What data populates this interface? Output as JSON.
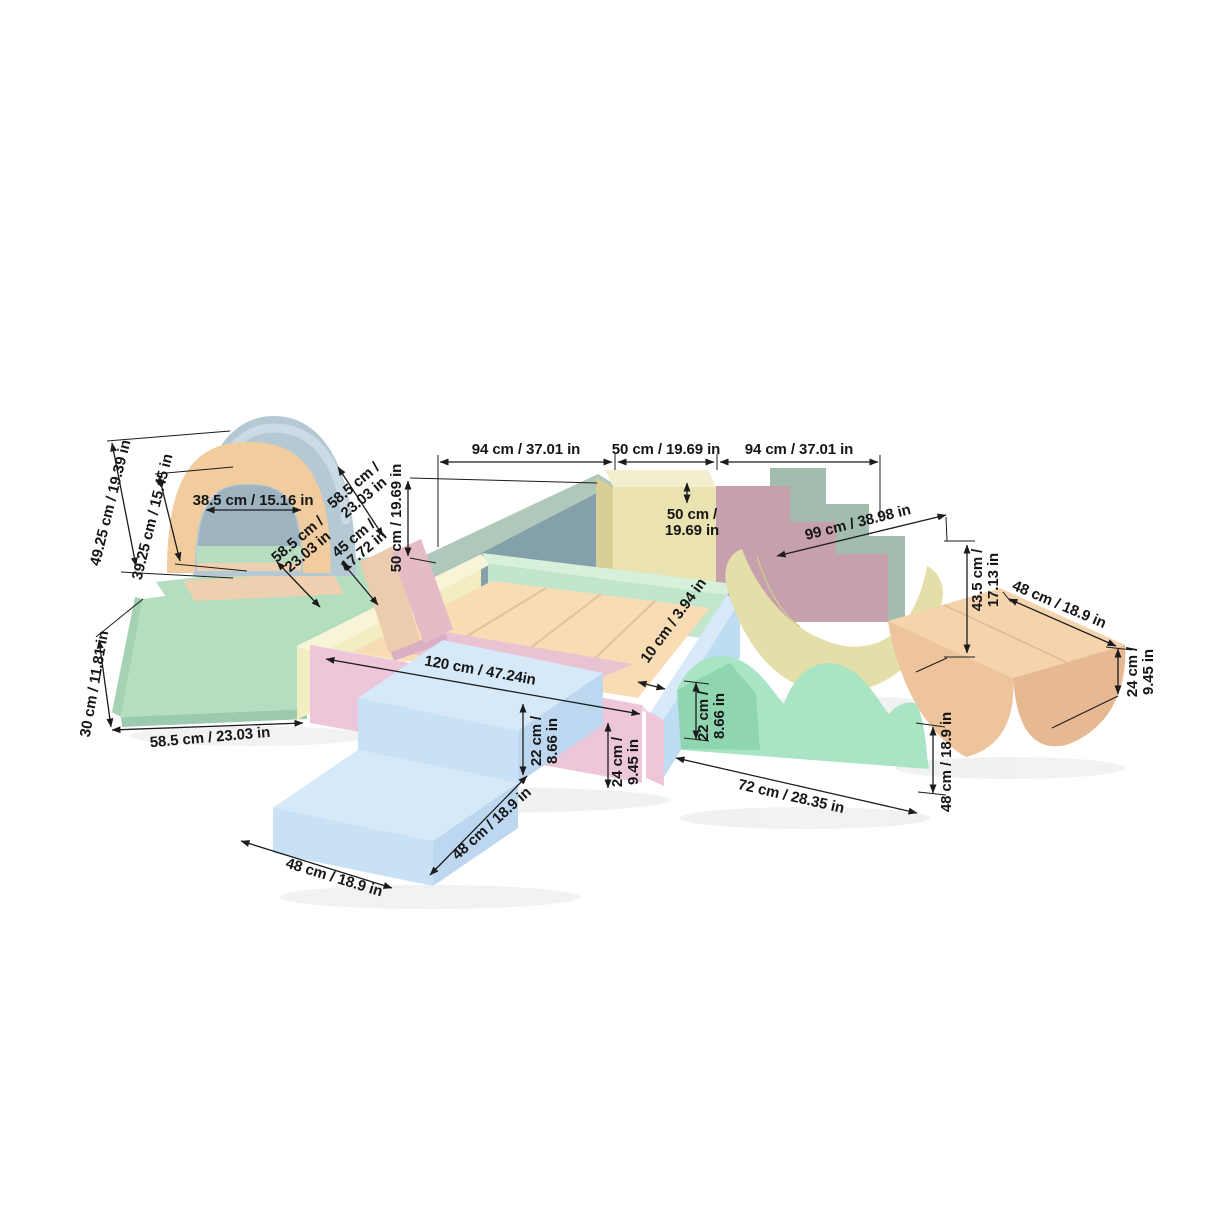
{
  "colors": {
    "bg": "#ffffff",
    "line": "#1c1c1c",
    "mat_green": "#b5dec1",
    "mat_green_edge": "#9ccaae",
    "mat_green_side": "#a5d2b3",
    "tunnel_blue": "#b5c9d5",
    "tunnel_blue_light": "#cfdde6",
    "tunnel_peach": "#f0cc9f",
    "tunnel_lining": "#9db3c0",
    "tunnel_floor_green": "#b9ddc1",
    "tunnel_floor_peach": "#eed0b0",
    "wedge_salmon": "#ecccae",
    "wedge_pink": "#e5bcc6",
    "sage": "#a2bcae",
    "sage_light": "#b0c8ba",
    "teal": "#84a0ab",
    "block_yellow": "#eae3b1",
    "block_yellow_top": "#f3eecd",
    "block_yellow_side": "#d8cf97",
    "mauve": "#c6a0ad",
    "pit_yellow": "#f3edc2",
    "pit_yellow_top": "#f8f4d8",
    "pit_green": "#c2e6cb",
    "pit_green_top": "#d7f0dc",
    "pit_blue": "#bedcf2",
    "pit_blue_top": "#d8eafa",
    "pit_pink": "#eec6da",
    "pit_pink_top": "#f6d9e8",
    "pit_floor": "#f7dcb4",
    "pit_seam": "#e3c29b",
    "wedge_in_pink": "#eac3d2",
    "wedge_in_pink_side": "#dcaec4",
    "stairs_top": "#d6e9f8",
    "stairs_front": "#c9e1f5",
    "stairs_right": "#bcd7ef",
    "stairs_side": "#aecfeb",
    "wave_mint": "#a9e5c5",
    "wave_mint_dark": "#8fd6b0",
    "rocker_yellow": "#e4dfa8",
    "rocker_yellow_seam": "#cfc98f",
    "rocker_peach_top": "#f4d3ad",
    "rocker_peach_front": "#eec49c",
    "rocker_peach_side": "#e7b993",
    "rocker_peach_seam": "#e2b88e"
  },
  "dims": {
    "tunnel_outer_height": {
      "l1": "49.25 cm / 19.39 in"
    },
    "tunnel_inner_height": {
      "l1": "39.25 cm / 15.45 in"
    },
    "tunnel_inner_width": {
      "l1": "38.5 cm / 15.16 in"
    },
    "tunnel_depth_top": {
      "l1": "58.5 cm /",
      "l2": "23.03 in"
    },
    "tunnel_depth_front": {
      "l1": "58.5 cm /",
      "l2": "23.03 in"
    },
    "wedge_height": {
      "l1": "45 cm /",
      "l2": "17.72 in"
    },
    "mat_thickness": {
      "l1": "30 cm / 11.81 in"
    },
    "mat_length": {
      "l1": "58.5 cm / 23.03 in"
    },
    "span_left": {
      "l1": "94 cm / 37.01 in"
    },
    "span_center": {
      "l1": "50 cm / 19.69 in"
    },
    "span_right": {
      "l1": "94 cm / 37.01 in"
    },
    "wall_height": {
      "l1": "50 cm / 19.69 in"
    },
    "block_height": {
      "l1": "50 cm /",
      "l2": "19.69 in"
    },
    "rocker_yellow_length": {
      "l1": "99 cm / 38.98 in"
    },
    "rocker_yellow_height": {
      "l1": "43.5 cm /",
      "l2": "17.13 in"
    },
    "pit_length": {
      "l1": "120 cm / 47.24in"
    },
    "pit_wall_thickness": {
      "l1": "10 cm / 3.94 in"
    },
    "pit_wall_inner": {
      "l1": "22 cm /",
      "l2": "8.66 in"
    },
    "pit_wall_outer": {
      "l1": "24 cm /",
      "l2": "9.45 in"
    },
    "stairs_width": {
      "l1": "48 cm / 18.9 in"
    },
    "stairs_depth": {
      "l1": "48 cm / 18.9 in"
    },
    "wave_height": {
      "l1": "22 cm /",
      "l2": "8.66 in"
    },
    "wave_length": {
      "l1": "72 cm / 28.35 in"
    },
    "wave_width": {
      "l1": "48 cm / 18.9 in"
    },
    "rocker_peach_width": {
      "l1": "48 cm / 18.9 in"
    },
    "rocker_peach_height": {
      "l1": "24 cm /",
      "l2": "9.45 in"
    }
  }
}
